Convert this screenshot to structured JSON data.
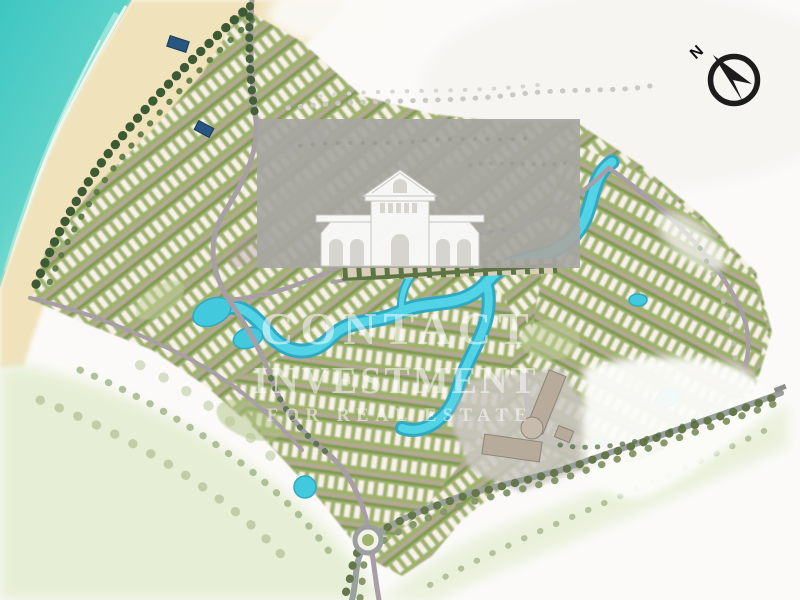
{
  "page": {
    "title": "Resort master plan site map"
  },
  "watermark": {
    "logo_icon": "classical-villa-logo",
    "line1": "CONTACT",
    "line2": "INVESTMENT",
    "line3": "FOR REAL ESTATE"
  },
  "compass": {
    "icon": "compass-north-arrow",
    "label": "N"
  },
  "colors": {
    "background": "#fbfaf8",
    "sea": "#3ec6c2",
    "sea_light": "#a8eadd",
    "sand": "#f0e2ba",
    "lagoon": "#52d4e6",
    "lagoon_edge": "#2fa9c4",
    "pool_deep": "#27567f",
    "row_green": "#9cb468",
    "hedge_green": "#7d9a50",
    "villa_roof": "#f6f2e6",
    "road": "#a89fa6",
    "boulevard": "#99a09d",
    "tree_dark": "#3c5a33",
    "tree_mid": "#5d7a44",
    "wash_green": "#e4eed2",
    "hotel": "#b7ab9c",
    "overlay_grey": "#a7a6a2",
    "compass_black": "#1c1c1c"
  }
}
